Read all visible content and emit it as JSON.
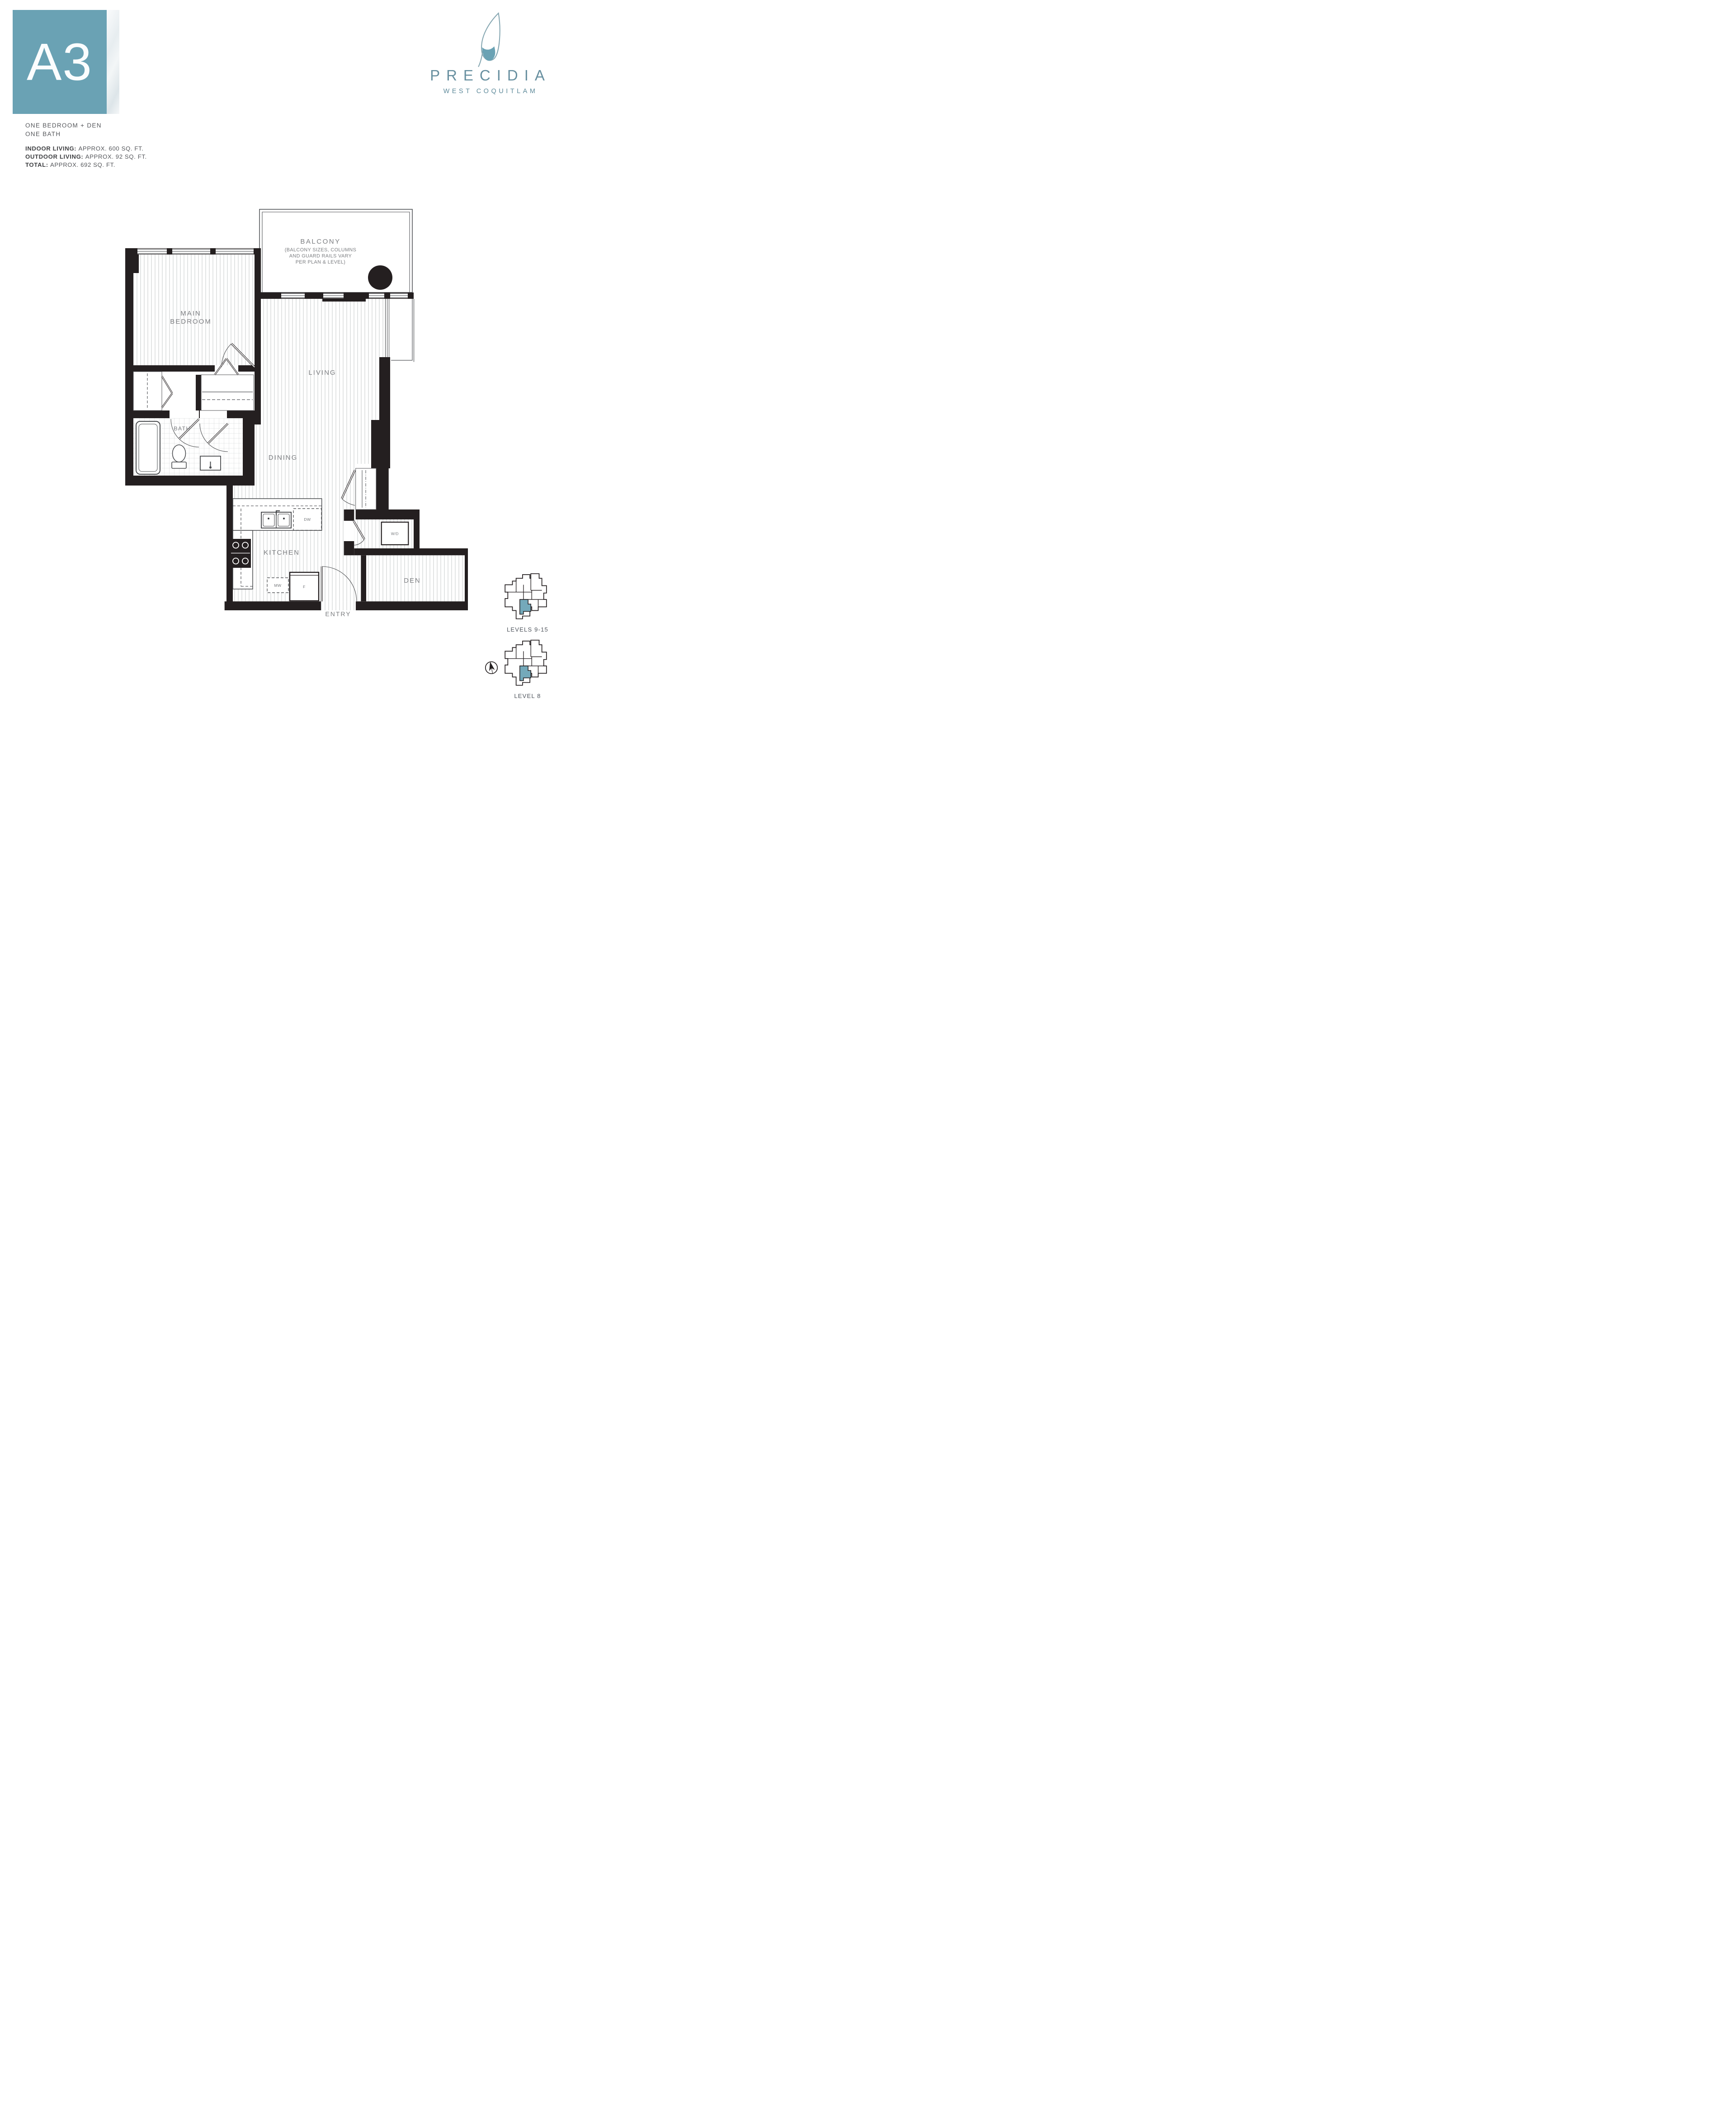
{
  "header": {
    "plan_code": "A3",
    "type_line1": "ONE BEDROOM + DEN",
    "type_line2": "ONE BATH",
    "stats": [
      {
        "label": "INDOOR LIVING:",
        "value": "APPROX. 600 SQ. FT."
      },
      {
        "label": "OUTDOOR LIVING:",
        "value": "APPROX. 92 SQ. FT."
      },
      {
        "label": "TOTAL:",
        "value": "APPROX. 692 SQ. FT."
      }
    ]
  },
  "brand": {
    "name": "PRECIDIA",
    "location": "WEST COQUITLAM"
  },
  "plan": {
    "balcony": {
      "title": "BALCONY",
      "note1": "(BALCONY SIZES, COLUMNS",
      "note2": "AND GUARD RAILS VARY",
      "note3": "PER PLAN & LEVEL)"
    },
    "rooms": {
      "bedroom_line1": "MAIN",
      "bedroom_line2": "BEDROOM",
      "living": "LIVING",
      "dining": "DINING",
      "bath": "BATH",
      "kitchen": "KITCHEN",
      "den": "DEN",
      "entry": "ENTRY"
    },
    "labels": {
      "dw": "DW",
      "mw": "MW",
      "fridge": "F",
      "washer_dryer": "W/D"
    }
  },
  "keyplans": {
    "upper": "LEVELS 9-15",
    "lower": "LEVEL 8"
  },
  "colors": {
    "teal": "#6aa2b4",
    "keyplan_teal": "#74a9ba",
    "wall": "#241f20",
    "line": "#54565a",
    "label": "#7b7d80"
  }
}
